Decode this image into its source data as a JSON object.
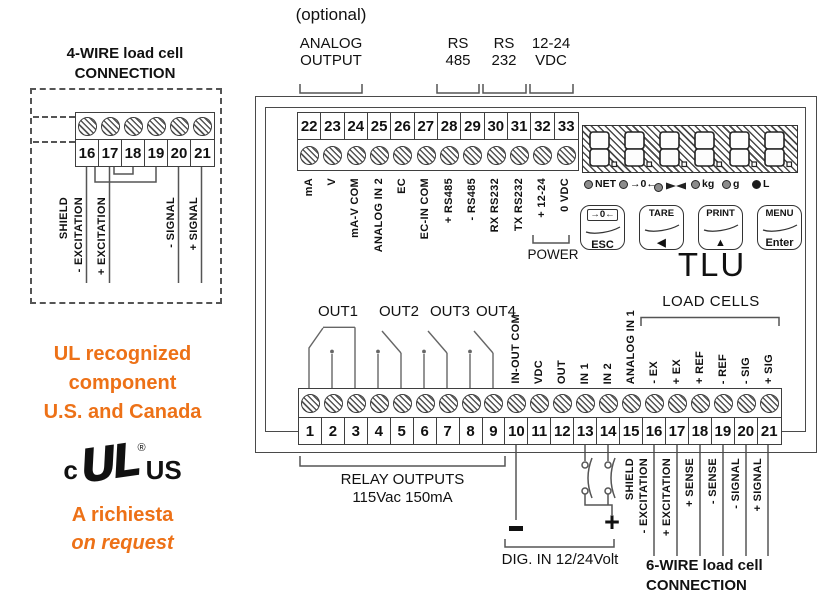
{
  "colors": {
    "orange": "#ED7117",
    "line": "#555555",
    "relay_line": "#666666"
  },
  "left_panel": {
    "four_wire_title": [
      "4-WIRE load cell",
      "CONNECTION"
    ],
    "terminals": [
      "16",
      "17",
      "18",
      "19",
      "20",
      "21"
    ],
    "wire_labels": [
      "SHIELD",
      "- EXCITATION",
      "+ EXCITATION",
      "- SIGNAL",
      "+ SIGNAL"
    ],
    "ul_lines": [
      "UL recognized",
      "component",
      "U.S. and Canada"
    ],
    "ul_logo": {
      "c": "c",
      "mark": "UL",
      "reg": "®",
      "us": "US"
    },
    "request_lines": [
      "A richiesta",
      "on request"
    ]
  },
  "top_area": {
    "optional": "(optional)",
    "groups": [
      {
        "lines": [
          "ANALOG",
          "OUTPUT"
        ]
      },
      {
        "lines": [
          "RS",
          "485"
        ]
      },
      {
        "lines": [
          "RS",
          "232"
        ]
      },
      {
        "lines": [
          "12-24",
          "VDC"
        ]
      }
    ]
  },
  "device": {
    "model": "TLU",
    "power_label": "POWER",
    "load_cells_label": "LOAD CELLS",
    "top_strip": {
      "numbers": [
        "22",
        "23",
        "24",
        "25",
        "26",
        "27",
        "28",
        "29",
        "30",
        "31",
        "32",
        "33"
      ],
      "labels": [
        "mA",
        "V",
        "mA-V COM",
        "ANALOG IN 2",
        "EC",
        "EC-IN COM",
        "+ RS485",
        "- RS485",
        "RX RS232",
        "TX RS232",
        "+ 12-24",
        "0 VDC"
      ]
    },
    "display": {
      "test_pattern": "8.8.8.8.8.8.",
      "leds": [
        {
          "label": "NET"
        },
        {
          "label": "→0←"
        },
        {
          "label": "",
          "icon": "bowtie"
        },
        {
          "label": "kg"
        },
        {
          "label": "g"
        },
        {
          "label": "L",
          "solid": true
        }
      ]
    },
    "buttons": [
      {
        "top": "→0←",
        "bottom": "ESC",
        "boxed": true
      },
      {
        "top": "TARE",
        "bottom": "◀"
      },
      {
        "top": "PRINT",
        "bottom": "▲"
      },
      {
        "top": "MENU",
        "bottom": "Enter"
      }
    ],
    "out_labels": [
      "OUT1",
      "OUT2",
      "OUT3",
      "OUT4"
    ],
    "bottom_strip": {
      "numbers": [
        "1",
        "2",
        "3",
        "4",
        "5",
        "6",
        "7",
        "8",
        "9",
        "10",
        "11",
        "12",
        "13",
        "14",
        "15",
        "16",
        "17",
        "18",
        "19",
        "20",
        "21"
      ],
      "labels": [
        {
          "terminal": 10,
          "text": "IN-OUT COM"
        },
        {
          "terminal": 11,
          "text": "VDC"
        },
        {
          "terminal": 12,
          "text": "OUT"
        },
        {
          "terminal": 13,
          "text": "IN 1"
        },
        {
          "terminal": 14,
          "text": "IN 2"
        },
        {
          "terminal": 15,
          "text": "ANALOG IN 1"
        },
        {
          "terminal": 16,
          "text": "- EX"
        },
        {
          "terminal": 17,
          "text": "+ EX"
        },
        {
          "terminal": 18,
          "text": "+ REF"
        },
        {
          "terminal": 19,
          "text": "- REF"
        },
        {
          "terminal": 20,
          "text": "- SIG"
        },
        {
          "terminal": 21,
          "text": "+ SIG"
        }
      ]
    }
  },
  "bottom_area": {
    "relay_caption": [
      "RELAY OUTPUTS",
      "115Vac 150mA"
    ],
    "dig_in": {
      "minus": "-",
      "plus": "+",
      "caption": "DIG. IN 12/24Volt"
    },
    "six_wire": {
      "labels": [
        "SHIELD",
        "- EXCITATION",
        "+ EXCITATION",
        "+ SENSE",
        "- SENSE",
        "- SIGNAL",
        "+ SIGNAL"
      ],
      "title": [
        "6-WIRE load cell",
        "CONNECTION"
      ]
    }
  }
}
